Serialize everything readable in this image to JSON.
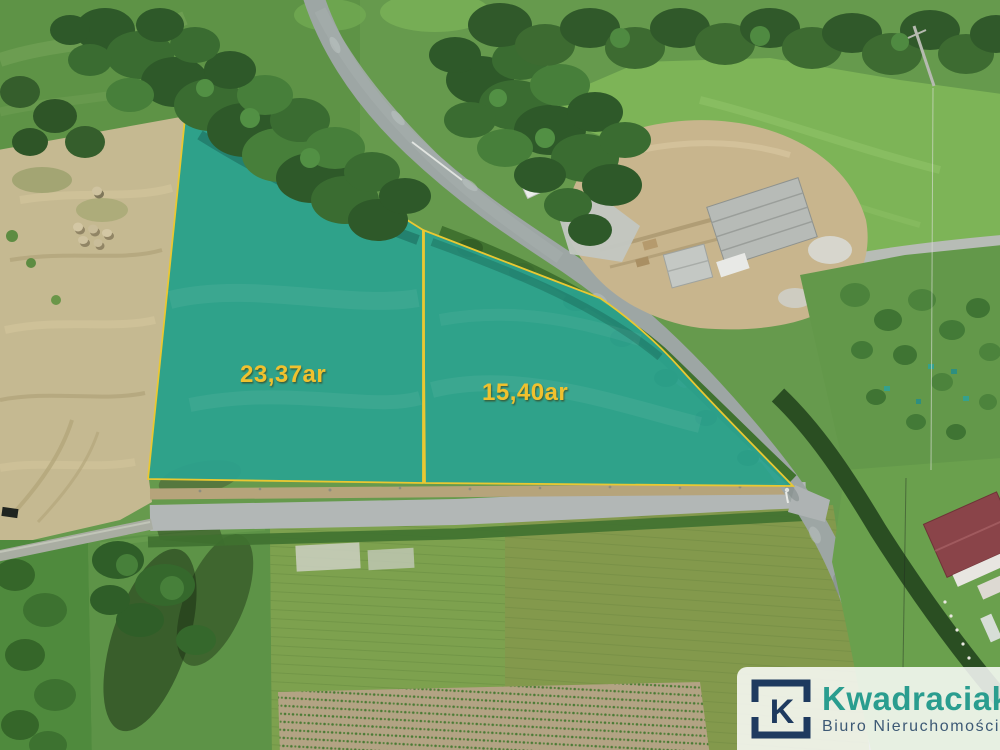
{
  "plots": [
    {
      "label": "23,37ar",
      "fill": "#2ba28f",
      "border": "#e9c832",
      "label_color": "#f0c12e"
    },
    {
      "label": "15,40ar",
      "fill": "#2ba28f",
      "border": "#e9c832",
      "label_color": "#f0c12e"
    }
  ],
  "logo": {
    "monogram": "K",
    "name": "Kwadraciak",
    "subtitle": "Biuro Nieruchomości",
    "monogram_color": "#1e3a5f",
    "name_color": "#2a9d8f",
    "subtitle_color": "#3d5975",
    "background": "rgba(255,255,255,0.84)"
  },
  "scene_colors": {
    "field_green": "#669a4d",
    "meadow_bright": "#7db457",
    "pale_mowed_field": "#c5b991",
    "tree_dark": "#315c2a",
    "asphalt_road": "#9da6a4",
    "gravel_road": "#b2b7b6",
    "construction_sand": "#c8b58d",
    "house_roof": "#8a4449"
  }
}
